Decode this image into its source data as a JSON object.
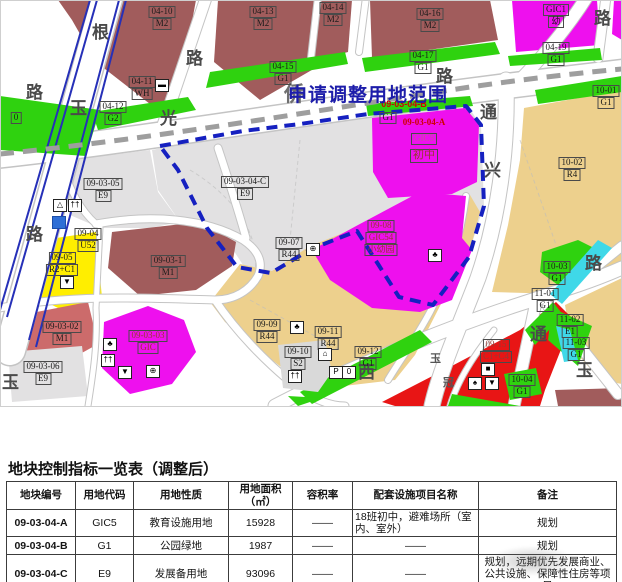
{
  "map": {
    "adjust_area_title": "申请调整用地范围",
    "labels": {
      "l0410": {
        "a": "04-10",
        "b": "M2"
      },
      "l0413": {
        "a": "04-13",
        "b": "M2"
      },
      "l0414": {
        "a": "04-14",
        "b": "M2"
      },
      "l0416": {
        "a": "04-16",
        "b": "M2"
      },
      "lTR": {
        "a": "GIC1",
        "b": "幼"
      },
      "l0411": {
        "a": "04-11",
        "b": "WH"
      },
      "l0412": {
        "a": "04-12",
        "b": "G2"
      },
      "l0415": {
        "a": "04-15",
        "b": "G1"
      },
      "l0417": {
        "a": "04-17",
        "b": "G1"
      },
      "l0419": {
        "a": "04-19",
        "b": "G1"
      },
      "l1001": {
        "a": "10-01",
        "b": "G1"
      },
      "l1002": {
        "a": "10-02",
        "b": "R4"
      },
      "l0305": {
        "a": "09-03-05",
        "b": "E9"
      },
      "l04C": {
        "a": "09-03-04-C",
        "b": "E9"
      },
      "lB": {
        "a": "09-03-04-B",
        "b": "G1"
      },
      "lA": {
        "a": "09-03-04-A",
        "b": "GIC5",
        "c": "初中"
      },
      "l0904": {
        "a": "09-04",
        "b": "U52"
      },
      "l0905": {
        "a": "09-05",
        "b": "R2+C1"
      },
      "l031": {
        "a": "09-03-1",
        "b": "M1"
      },
      "l0302": {
        "a": "09-03-02",
        "b": "M1"
      },
      "l0306": {
        "a": "09-03-06",
        "b": "E9"
      },
      "l0303": {
        "a": "09-03-03",
        "b": "GIC"
      },
      "l0907": {
        "a": "09-07",
        "b": "R44"
      },
      "l0908": {
        "a": "09-08",
        "b": "GIC54",
        "c": "小幼园"
      },
      "l0909": {
        "a": "09-09",
        "b": "R44"
      },
      "l0910": {
        "a": "09-10",
        "b": "S2"
      },
      "l0911": {
        "a": "09-11",
        "b": "R44"
      },
      "l0912": {
        "a": "09-12",
        "b": "G1"
      },
      "l0915": {
        "a": "09-15",
        "b": "C1+C4"
      },
      "l1003": {
        "a": "10-03",
        "b": "G1"
      },
      "l1101": {
        "a": "11-01",
        "b": "G1"
      },
      "l1102": {
        "a": "11-02",
        "b": "E1"
      },
      "l1103": {
        "a": "11-03",
        "b": "G1"
      },
      "l1004": {
        "a": "10-04",
        "b": "G1"
      },
      "lZero": {
        "a": "0"
      }
    },
    "road_chars": [
      "根",
      "路",
      "玉",
      "路",
      "路",
      "玉",
      "光",
      "侨",
      "路",
      "路",
      "通",
      "兴",
      "路",
      "通",
      "玉",
      "西",
      "玉",
      "冠"
    ],
    "icons": {
      "bus": "▬",
      "tent": "△",
      "persons": "††",
      "market": "▼",
      "tree": "♣",
      "hospital": "⊕",
      "wheel": "⊕",
      "house": "⌂",
      "parking": "P",
      "zero": "0",
      "square": "■",
      "spade": "♠",
      "arrow": "▼"
    },
    "colors": {
      "industry_m2": "#a15c5c",
      "green_g1": "#2fd20f",
      "gic_magenta": "#ee10ee",
      "resid_r4": "#edd08d",
      "reserve_e9": "#e2e1e2",
      "commerce_c1": "#e81515",
      "yellow_r2c1": "#ffee00",
      "river": "#3fd8e8",
      "boundary_blue": "#1520c0",
      "label_red": "#cf0000"
    }
  },
  "table": {
    "title": "地块控制指标一览表（调整后）",
    "headers": [
      "地块编号",
      "用地代码",
      "用地性质",
      "用地面积",
      "容积率",
      "配套设施项目名称",
      "备注"
    ],
    "area_unit": "（㎡）",
    "rows": [
      {
        "code": "09-03-04-A",
        "use_code": "GIC5",
        "use_type": "教育设施用地",
        "area": "15928",
        "far": "——",
        "facilities": "18班初中，避难场所（室内、室外）",
        "remark": "规划"
      },
      {
        "code": "09-03-04-B",
        "use_code": "G1",
        "use_type": "公园绿地",
        "area": "1987",
        "far": "——",
        "facilities": "——",
        "remark": "规划"
      },
      {
        "code": "09-03-04-C",
        "use_code": "E9",
        "use_type": "发展备用地",
        "area": "93096",
        "far": "——",
        "facilities": "——",
        "remark": "规划，远期优先发展商业、公共设施、保障性住房等项目"
      }
    ]
  }
}
